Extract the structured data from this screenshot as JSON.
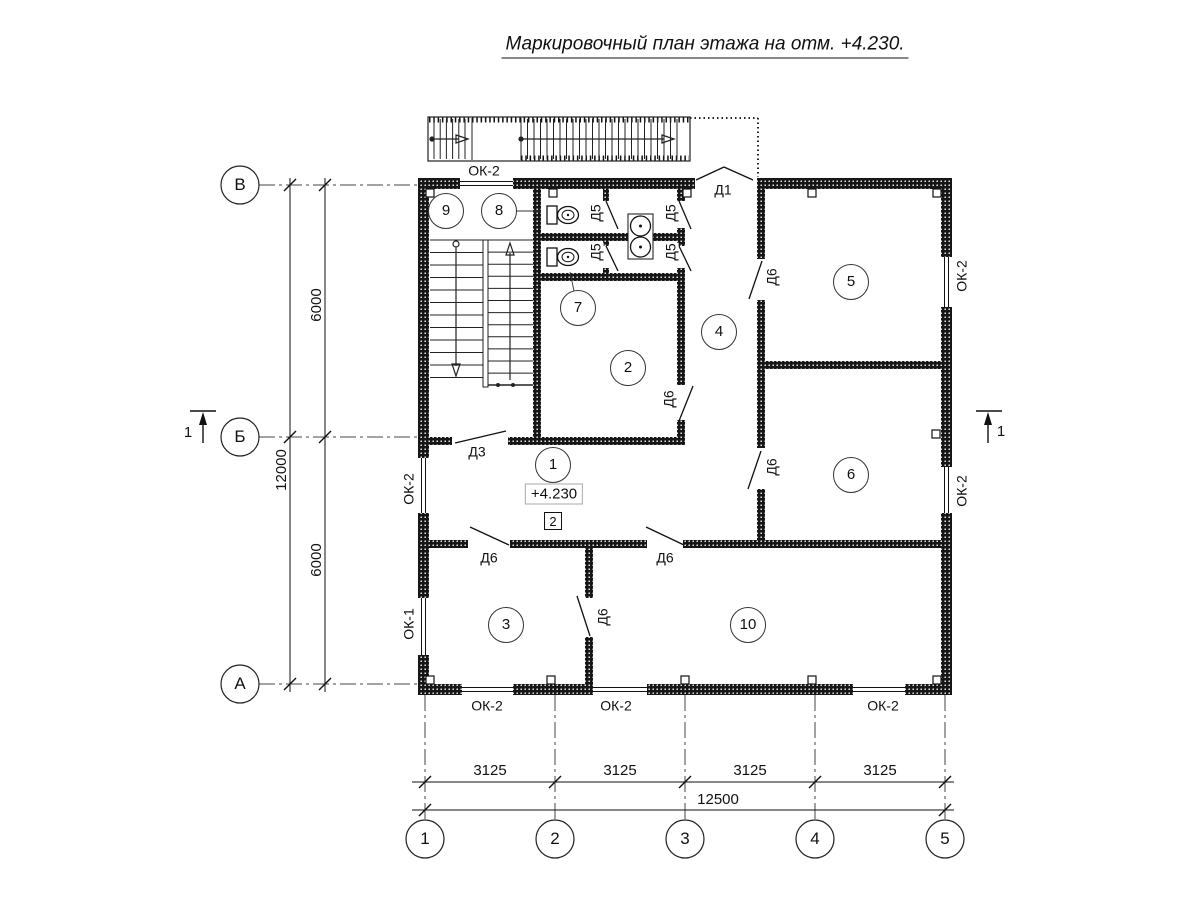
{
  "title": "Маркировочный план этажа на отм. +4.230.",
  "axes": {
    "rows": [
      "В",
      "Б",
      "А"
    ],
    "cols": [
      "1",
      "2",
      "3",
      "4",
      "5"
    ]
  },
  "rooms": [
    "1",
    "2",
    "3",
    "4",
    "5",
    "6",
    "7",
    "8",
    "9",
    "10"
  ],
  "marks": {
    "d1": "Д1",
    "d3": "Д3",
    "d5": "Д5",
    "d6": "Д6",
    "ok1": "ОК-1",
    "ok2": "ОК-2",
    "elevation": "+4.230",
    "floor_flag": "2",
    "section": "1"
  },
  "dims": {
    "seg_h": "3125",
    "total_h": "12500",
    "seg_v": "6000",
    "total_v": "12000"
  },
  "colors": {
    "ink": "#111111",
    "axis_line": "#444444",
    "wall_fill": "#161616"
  }
}
